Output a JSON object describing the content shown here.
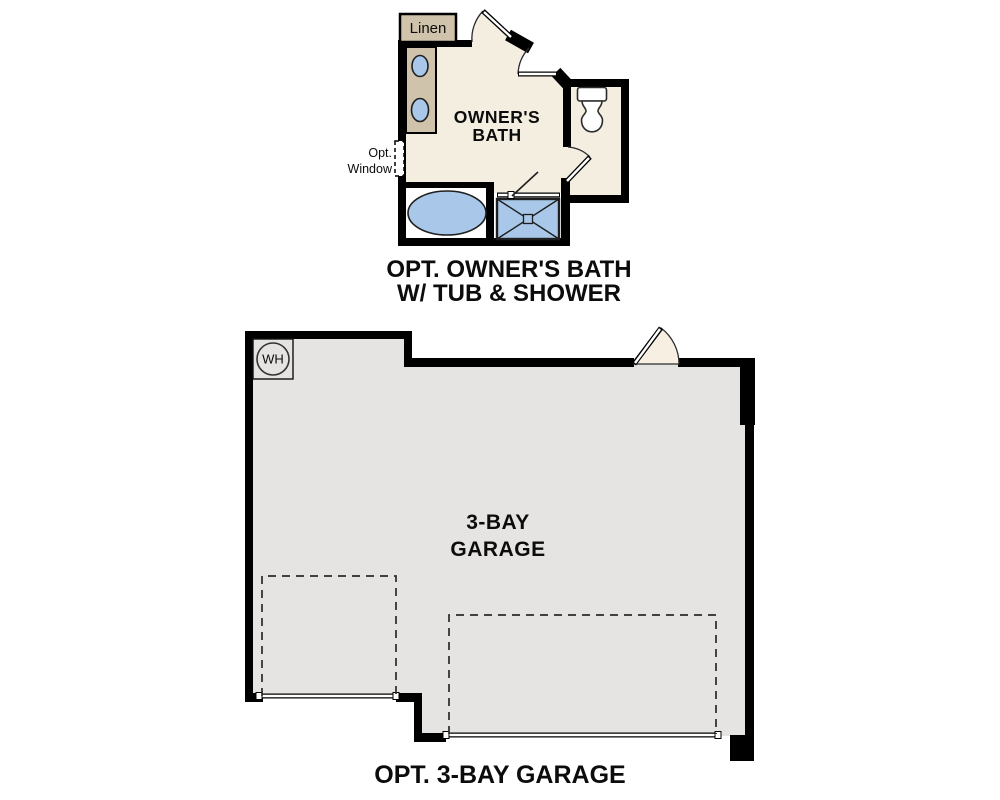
{
  "colors": {
    "wall": "#000000",
    "bath_floor": "#f4eee1",
    "cabinet_tan": "#cfc4ab",
    "fixture_blue": "#a9c8e9",
    "garage_floor": "#e5e4e2",
    "door_leaf_cream": "#f6efe2",
    "room_white": "#ffffff",
    "text": "#0c0c0c"
  },
  "owners_bath": {
    "linen_label": "Linen",
    "room_name": {
      "line1": "OWNER'S",
      "line2": "BATH"
    },
    "window_note": {
      "line1": "Opt.",
      "line2": "Window"
    },
    "caption": {
      "line1": "OPT. OWNER'S BATH",
      "line2": "W/ TUB & SHOWER"
    }
  },
  "garage": {
    "water_heater_label": "WH",
    "room_name": {
      "line1": "3-BAY",
      "line2": "GARAGE"
    },
    "caption": "OPT. 3-BAY GARAGE"
  }
}
